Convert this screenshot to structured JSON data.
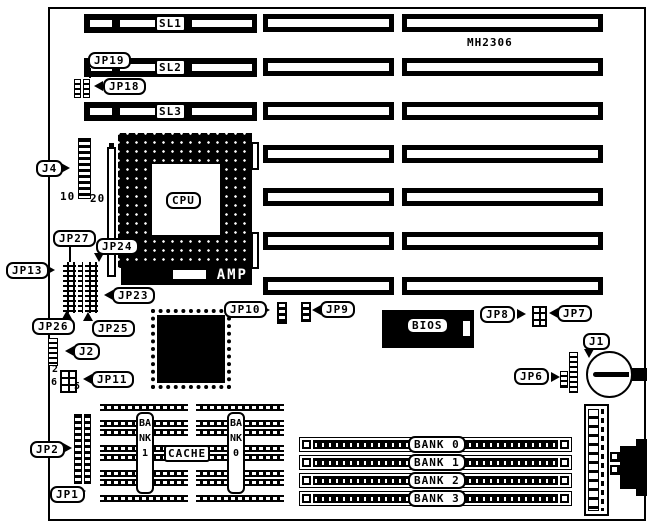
{
  "colors": {
    "ink": "#000000",
    "paper": "#ffffff"
  },
  "labels": {
    "model": "MH2306",
    "slots": {
      "sl1": "SL1",
      "sl2": "SL2",
      "sl3": "SL3"
    },
    "cpu": "CPU",
    "amp": "AMP",
    "bios": "BIOS",
    "cache": "CACHE",
    "jumpers": {
      "jp19": "JP19",
      "jp18": "JP18",
      "j4": "J4",
      "jp27": "JP27",
      "jp24": "JP24",
      "jp13": "JP13",
      "jp23": "JP23",
      "jp26": "JP26",
      "jp25": "JP25",
      "j2": "J2",
      "jp11": "JP11",
      "jp2": "JP2",
      "jp1": "JP1",
      "jp10": "JP10",
      "jp9": "JP9",
      "jp8": "JP8",
      "jp7": "JP7",
      "j1": "J1",
      "jp6": "JP6"
    },
    "pins": {
      "j4_left": "10",
      "j4_right": "20",
      "jp11_top": "2",
      "jp11_bottom_left": "6",
      "jp11_bottom_right": "5"
    },
    "cache_banks": {
      "bank1": "BANK1",
      "bank0": "BANK0"
    },
    "simm_banks": [
      "BANK 0",
      "BANK 1",
      "BANK 2",
      "BANK 3"
    ]
  }
}
